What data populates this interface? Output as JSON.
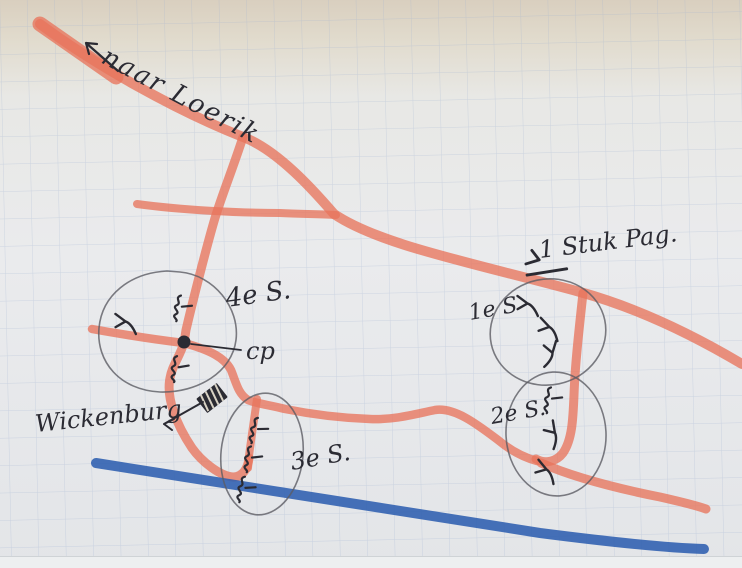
{
  "map": {
    "kind": "hand-drawn field sketch on squared paper",
    "labels": {
      "naar_loerik": "naar Loerik",
      "stuk_pag": "1 Stuk Pag.",
      "section4": "4e S.",
      "command_post": "cp",
      "wickenburg": "Wickenburg",
      "section3": "3e S.",
      "section1": "1e S",
      "section2": "2e S."
    },
    "icons": {
      "command-post-dot": "filled-circle",
      "building-wickenburg": "hatched-dark-rectangle",
      "section-marker": "squiggle-with-dash",
      "weapon-fork": "forked-line",
      "anti-tank-gun": "fork-with-bar",
      "direction-arrow": "line-with-arrowhead"
    }
  },
  "colors": {
    "road_red": "#e8745c",
    "river_blue": "#2e5faf",
    "ink": "#2b2b33",
    "pencil": "#5c5c64",
    "grid": "#9fb0cf",
    "paper_top": "#d9cfbf",
    "paper": "#eaebed"
  }
}
